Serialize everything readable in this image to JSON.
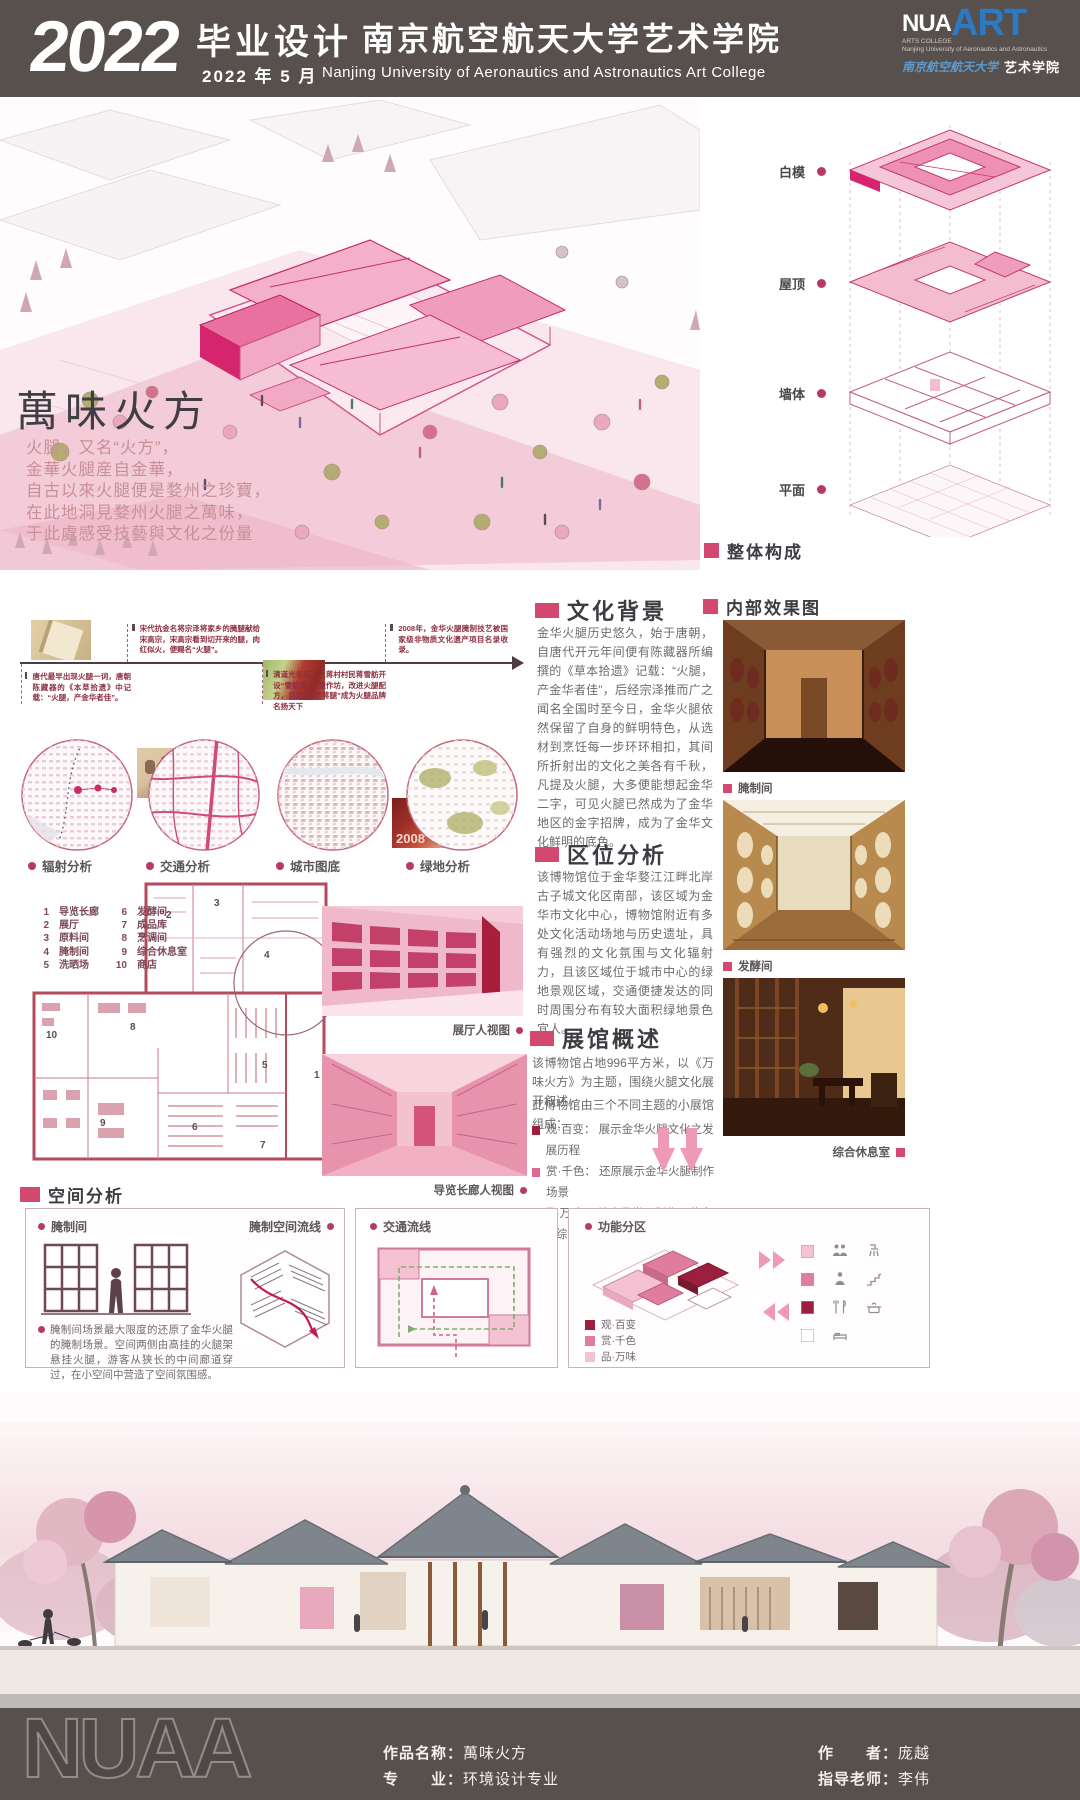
{
  "colors": {
    "accent": "#d6246e",
    "heading_square": "#d4496f",
    "dark_bar": "#57504d",
    "maroon_text": "#8e2f3f",
    "logo_blue": "#2b7bc4",
    "plan_line": "#b5495e"
  },
  "header": {
    "year": "2022",
    "title_cn": "毕业设计",
    "date": "2022 年 5 月",
    "school_cn": "南京航空航天大学艺术学院",
    "school_en": "Nanjing  University  of  Aeronautics  and  Astronautics  Art  College",
    "logo_main": "NUA",
    "logo_art": "ART",
    "logo_sub1": "ARTS COLLEGE",
    "logo_sub2": "Nanjing University  of Aeronautics and Astronautics",
    "logo_script": "南京航空航天大学",
    "logo_college": "艺术学院"
  },
  "hero": {
    "title": "萬味火方",
    "poem": [
      "火腿，又名“火方”，",
      "金華火腿産自金華，",
      "自古以來火腿便是婺州之珍寶，",
      "在此地洞見婺州火腿之萬味，",
      "于此處感受技藝與文化之份量"
    ],
    "axon_labels": [
      "白模",
      "屋顶",
      "墙体",
      "平面"
    ],
    "axon_caption": "整体构成"
  },
  "timeline": {
    "above": [
      {
        "text": "宋代抗金名将宗泽将家乡的腌腿献给宋高宗，宋高宗看到切开来的腿，肉红似火，便赐名“火腿”。"
      },
      {
        "text": "2008年，金华火腿腌制技艺被国家级非物质文化遗产项目名录收录。"
      }
    ],
    "below": [
      {
        "text": "唐代最早出现火腿一词，唐朝陈藏器的《本草拾遗》中记载：“火腿，产金华者佳”。"
      },
      {
        "text": "清道光年间，上蒋村村民蒋雪舫开设“雪舫蒋”火腿作坊，改进火腿配方，自此“雪舫蒋腿”成为火腿品牌名扬天下"
      }
    ],
    "badge": "2008"
  },
  "circles": [
    {
      "label": "辐射分析"
    },
    {
      "label": "交通分析"
    },
    {
      "label": "城市图底"
    },
    {
      "label": "绿地分析"
    }
  ],
  "culture": {
    "title": "文化背景",
    "body": "金华火腿历史悠久，始于唐朝，自唐代开元年间便有陈藏器所编撰的《草本拾遗》记载：“火腿，产金华者佳”，后经宗泽推而广之闻名全国时至今日，金华火腿依然保留了自身的鲜明特色，从选材到烹饪每一步环环相扣，其间所折射出的文化之美各有千秋，凡提及火腿，大多便能想起金华二字，可见火腿已然成为了金华地区的金字招牌，成为了金华文化鲜明的底色。"
  },
  "location": {
    "title": "区位分析",
    "body": "该博物馆位于金华婺江江畔北岸古子城文化区南部，该区域为金华市文化中心，博物馆附近有多处文化活动场地与历史遗址，具有强烈的文化氛围与文化辐射力，且该区域位于城市中心的绿地景观区域，交通便捷发达的同时周围分布有较大面积绿地景色宜人。"
  },
  "overview": {
    "title": "展馆概述",
    "body1": "该博物馆占地996平方米，以《万味火方》为主题，围绕火腿文化展开叙述。",
    "body2": "此博物馆由三个不同主题的小展馆组成：",
    "bullets": [
      "观·百变： 展示金华火腿文化之发展历程",
      "赏·千色： 还原展示金华火腿制作场景",
      "品·万味： 结合品尝、制作、休息的综合功能空间"
    ],
    "bullet_colors": [
      "#9c1f3f",
      "#dd6a90",
      "#f2b8cb"
    ]
  },
  "legend": {
    "items": [
      {
        "num": "1",
        "name": "导览长廊"
      },
      {
        "num": "2",
        "name": "展厅"
      },
      {
        "num": "3",
        "name": "原料间"
      },
      {
        "num": "4",
        "name": "腌制间"
      },
      {
        "num": "5",
        "name": "洗晒场"
      },
      {
        "num": "6",
        "name": "发酵间"
      },
      {
        "num": "7",
        "name": "成品库"
      },
      {
        "num": "8",
        "name": "烹调间"
      },
      {
        "num": "9",
        "name": "综合休息室"
      },
      {
        "num": "10",
        "name": "商店"
      }
    ]
  },
  "views": {
    "hall": "展厅人视图",
    "corridor": "导览长廊人视图"
  },
  "interior": {
    "title": "内部效果图",
    "photos": [
      {
        "label": "腌制间"
      },
      {
        "label": "发酵间"
      },
      {
        "label": "综合休息室"
      }
    ]
  },
  "space": {
    "title": "空间分析",
    "pickle_label": "腌制间",
    "flow_label": "腌制空间流线",
    "desc": "腌制间场景最大限度的还原了金华火腿的腌制场景。空间两侧由高挂的火腿架悬挂火腿，游客从狭长的中间廊道穿过，在小空间中营造了空间氛围感。",
    "traffic_label": "交通流线",
    "zone_label": "功能分区",
    "zones": [
      {
        "label": "观·百变",
        "color": "#9c1f3f"
      },
      {
        "label": "赏·千色",
        "color": "#e07d9f"
      },
      {
        "label": "品·万味",
        "color": "#f4c2d3"
      }
    ],
    "swatches": [
      "#f4c2d3",
      "#e07d9f",
      "#9c1f3f",
      "#ffffff"
    ]
  },
  "footer": {
    "logo": "NUAA",
    "name_label": "作品名称：",
    "name_value": "萬味火方",
    "major_label": "专　　业：",
    "major_value": "环境设计专业",
    "author_label": "作　　者：",
    "author_value": "庞越",
    "advisor_label": "指导老师：",
    "advisor_value": "李伟"
  }
}
